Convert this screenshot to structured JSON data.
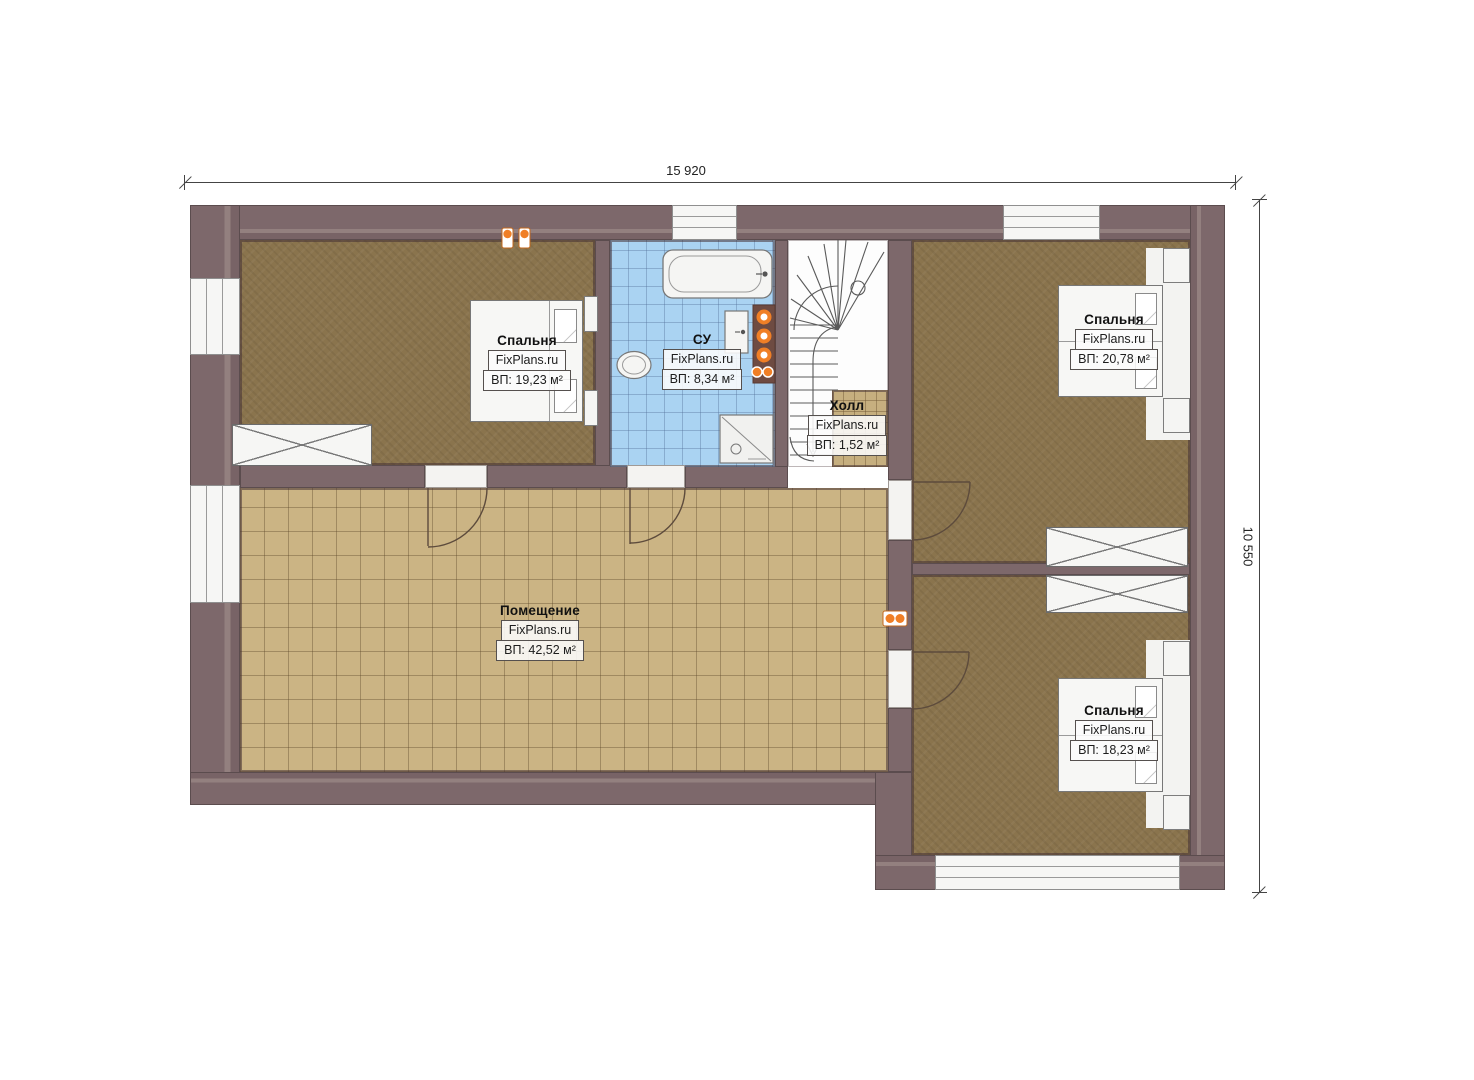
{
  "plan": {
    "title": "floor-plan",
    "dimensions": {
      "width": "15 920",
      "height": "10 550"
    },
    "rooms": [
      {
        "name": "Спальня",
        "brand": "FixPlans.ru",
        "area": "ВП: 19,23 м²"
      },
      {
        "name": "СУ",
        "brand": "FixPlans.ru",
        "area": "ВП: 8,34 м²"
      },
      {
        "name": "Холл",
        "brand": "FixPlans.ru",
        "area": "ВП: 1,52 м²"
      },
      {
        "name": "Спальня",
        "brand": "FixPlans.ru",
        "area": "ВП: 20,78 м²"
      },
      {
        "name": "Помещение",
        "brand": "FixPlans.ru",
        "area": "ВП: 42,52 м²"
      },
      {
        "name": "Спальня",
        "brand": "FixPlans.ru",
        "area": "ВП: 18,23 м²"
      }
    ],
    "colors": {
      "wall": "#7d686b",
      "bedroom_floor": "#8a744d",
      "tile_floor": "#cbb484",
      "bath_floor": "#aad3f2",
      "hall_floor": "#c6af7f",
      "accent_orange": "#f07f26"
    }
  }
}
